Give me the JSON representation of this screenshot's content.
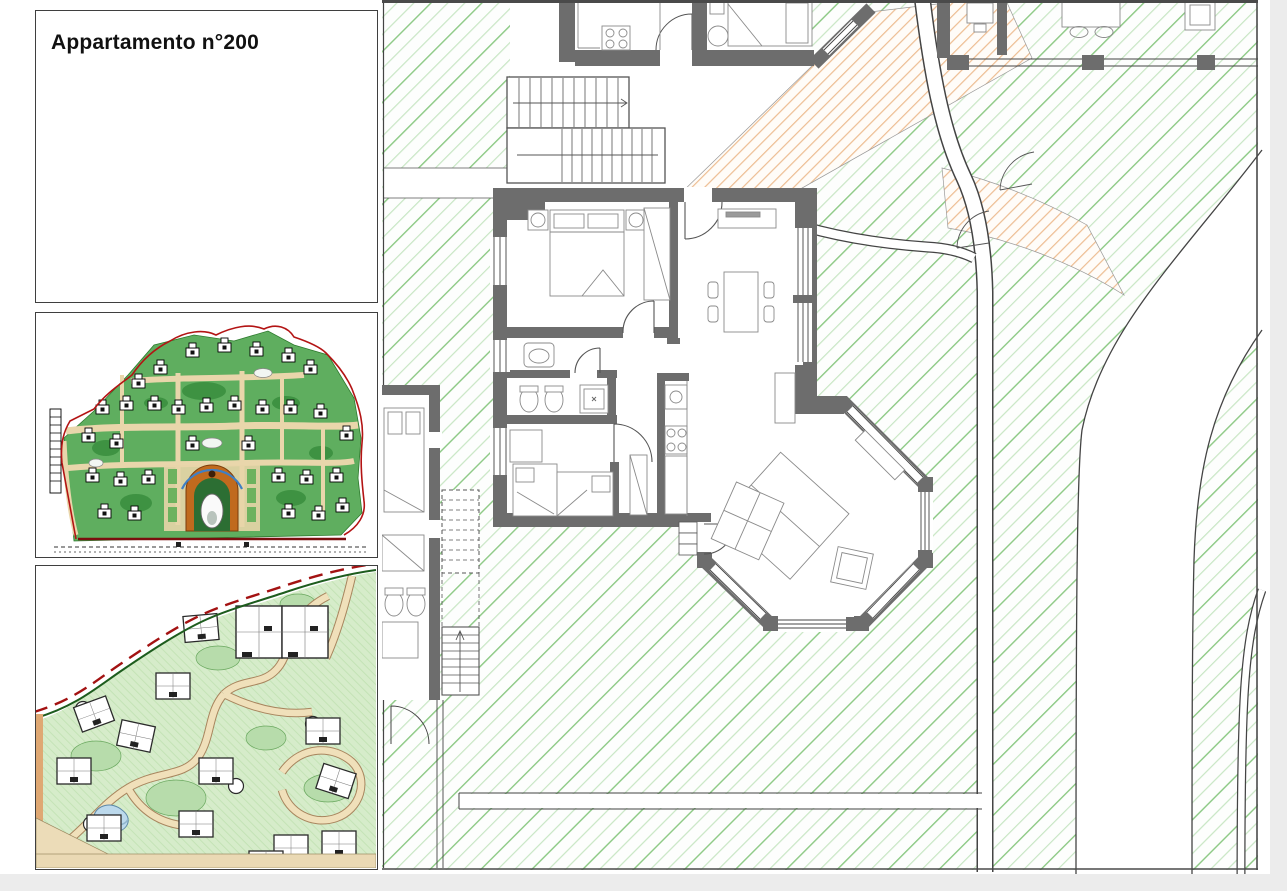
{
  "title_panel": {
    "title": "Appartamento n°200"
  },
  "colors": {
    "wall_gray": "#6d6d6d",
    "garden_hatch_green": "#8cc984",
    "garden_hatch_light": "#c8e6c4",
    "path_hatch_orange": "#edbd92",
    "masterplan_green": "#5fae5f",
    "masterplan_lawn": "#3e9242",
    "masterplan_road_beige": "#e9d6ab",
    "masterplan_center_orange": "#c06a1e",
    "boundary_red": "#b31414",
    "siteplan_green": "#d6ecca",
    "siteplan_path_beige": "#f0e0ba",
    "pool_blue": "#bcd9ec",
    "page_margin_gray": "#ececec"
  }
}
